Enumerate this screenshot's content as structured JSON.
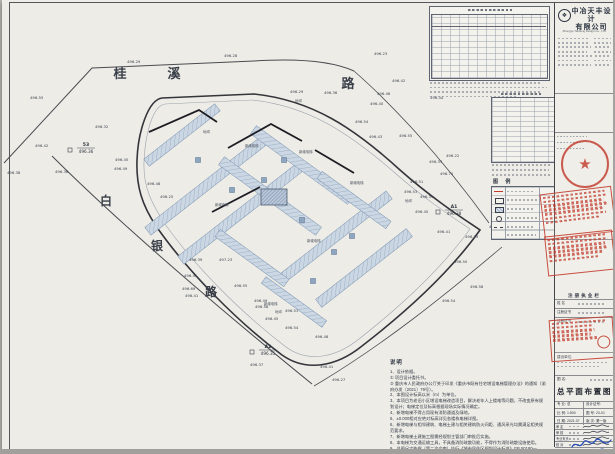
{
  "company": {
    "name_line1": "中冶天丰设计",
    "name_line2": "有限公司",
    "english": "Zhongye Tianfeng Design Co., LTD"
  },
  "title_block": {
    "registration_header": "注册执业栏",
    "reg_rows": [
      "姓  名",
      "注册证书",
      "注册证书"
    ],
    "client_label": "建设单位:",
    "drawing_name_label": "图 名:",
    "drawing_name": "总平面布置图",
    "fields": [
      {
        "label": "专 业",
        "value": "总"
      },
      {
        "label": "设计证号",
        "value": ""
      },
      {
        "label": "比 例",
        "value": "1:500"
      },
      {
        "label": "图 号",
        "value": "23-01"
      },
      {
        "label": "日 期",
        "value": "2021.07"
      },
      {
        "label": "版 次",
        "value": "第一版"
      }
    ],
    "sig_rows": [
      "审 定",
      "审 核",
      "专业负责",
      "校 对",
      "设 计"
    ]
  },
  "legend": {
    "title": "图 例"
  },
  "notes": {
    "title": "说明",
    "lines": [
      "1、设计依据。",
      "① 项目设计委托书。",
      "② 重庆市人民政府办公厅关于印发《重庆市既有住宅增设电梯管理办法》的通知（渝府办发〔2021〕79号）。",
      "2、本图设计标高以米（m）为单位。",
      "3、本项目为老旧小区增设电梯改造项目，解决老年人上楼难等问题，不改变原有规划设计；电梯定位及标高根据现场实际情况确定。",
      "4、新增电梯不得占用现有消防通道及绿地。",
      "5、±0.000相对应绝对标高详见各楼栋电梯详图。",
      "6、新增电梯与相邻建筑、电梯土建与相关建筑防火间距、通风采光均需满足相关规范要求。",
      "7、新增电梯土建施工图需经规划主管部门审批后实施。",
      "8、本电梯为交通运输工具，不具备消防疏散功能，不得作为消防疏散设施使用。",
      "9、总图尺寸依据（第二次会审）执行《城市居住区规划设计标准》GB 50180—2018。"
    ]
  },
  "plan": {
    "road_chars": [
      {
        "c": "桂",
        "x": 118,
        "y": 78,
        "s": 13
      },
      {
        "c": "溪",
        "x": 172,
        "y": 78,
        "s": 13
      },
      {
        "c": "路",
        "x": 346,
        "y": 88,
        "s": 13
      },
      {
        "c": "白",
        "x": 104,
        "y": 205,
        "s": 12
      },
      {
        "c": "银",
        "x": 155,
        "y": 250,
        "s": 12
      },
      {
        "c": "路",
        "x": 209,
        "y": 296,
        "s": 12
      }
    ],
    "ground_label": "地坪",
    "ground_pts": [
      {
        "x": 201,
        "y": 133
      },
      {
        "x": 293,
        "y": 102
      },
      {
        "x": 403,
        "y": 202
      },
      {
        "x": 273,
        "y": 313
      }
    ],
    "elevator_label": "新增电梯",
    "elevator_pts": [
      {
        "x": 243,
        "y": 147
      },
      {
        "x": 297,
        "y": 153
      },
      {
        "x": 348,
        "y": 184
      },
      {
        "x": 213,
        "y": 206
      },
      {
        "x": 305,
        "y": 242
      },
      {
        "x": 262,
        "y": 305
      }
    ],
    "refs": [
      {
        "name": "A1",
        "elev": "496.38",
        "x": 452,
        "y": 208
      },
      {
        "name": "A2",
        "elev": "496.35",
        "x": 266,
        "y": 348
      },
      {
        "name": "53",
        "elev": "496.36",
        "x": 84,
        "y": 146
      }
    ],
    "spots": [
      {
        "v": "496.29",
        "x": 125,
        "y": 63
      },
      {
        "v": "496.28",
        "x": 222,
        "y": 57
      },
      {
        "v": "496.23",
        "x": 372,
        "y": 55
      },
      {
        "v": "496.55",
        "x": 28,
        "y": 99
      },
      {
        "v": "496.42",
        "x": 33,
        "y": 147
      },
      {
        "v": "496.38",
        "x": 5,
        "y": 174
      },
      {
        "v": "496.38",
        "x": 53,
        "y": 173
      },
      {
        "v": "496.32",
        "x": 93,
        "y": 128
      },
      {
        "v": "496.45",
        "x": 113,
        "y": 161
      },
      {
        "v": "496.49",
        "x": 112,
        "y": 170
      },
      {
        "v": "496.48",
        "x": 145,
        "y": 185
      },
      {
        "v": "496.25",
        "x": 158,
        "y": 198
      },
      {
        "v": "496.29",
        "x": 288,
        "y": 93
      },
      {
        "v": "496.36",
        "x": 322,
        "y": 94
      },
      {
        "v": "496.46",
        "x": 375,
        "y": 95
      },
      {
        "v": "496.42",
        "x": 390,
        "y": 82
      },
      {
        "v": "496.40",
        "x": 368,
        "y": 105
      },
      {
        "v": "496.54",
        "x": 353,
        "y": 123
      },
      {
        "v": "496.43",
        "x": 367,
        "y": 138
      },
      {
        "v": "496.55",
        "x": 397,
        "y": 137
      },
      {
        "v": "496.44",
        "x": 428,
        "y": 99
      },
      {
        "v": "496.22",
        "x": 444,
        "y": 157
      },
      {
        "v": "496.33",
        "x": 427,
        "y": 163
      },
      {
        "v": "496.70",
        "x": 438,
        "y": 175
      },
      {
        "v": "496.51",
        "x": 408,
        "y": 183
      },
      {
        "v": "496.53",
        "x": 402,
        "y": 193
      },
      {
        "v": "496.33",
        "x": 418,
        "y": 198
      },
      {
        "v": "496.45",
        "x": 413,
        "y": 213
      },
      {
        "v": "496.25",
        "x": 487,
        "y": 228
      },
      {
        "v": "496.39",
        "x": 463,
        "y": 238
      },
      {
        "v": "496.41",
        "x": 435,
        "y": 233
      },
      {
        "v": "496.39",
        "x": 187,
        "y": 261
      },
      {
        "v": "497.23",
        "x": 217,
        "y": 261
      },
      {
        "v": "496.41",
        "x": 182,
        "y": 277
      },
      {
        "v": "496.69",
        "x": 180,
        "y": 290
      },
      {
        "v": "496.41",
        "x": 183,
        "y": 297
      },
      {
        "v": "496.55",
        "x": 232,
        "y": 287
      },
      {
        "v": "496.49",
        "x": 252,
        "y": 302
      },
      {
        "v": "496.58",
        "x": 253,
        "y": 308
      },
      {
        "v": "496.51",
        "x": 283,
        "y": 312
      },
      {
        "v": "496.45",
        "x": 263,
        "y": 320
      },
      {
        "v": "496.54",
        "x": 283,
        "y": 329
      },
      {
        "v": "496.50",
        "x": 452,
        "y": 263
      },
      {
        "v": "496.58",
        "x": 468,
        "y": 288
      },
      {
        "v": "496.54",
        "x": 440,
        "y": 302
      },
      {
        "v": "496.48",
        "x": 313,
        "y": 338
      },
      {
        "v": "496.37",
        "x": 248,
        "y": 366
      },
      {
        "v": "496.41",
        "x": 318,
        "y": 368
      },
      {
        "v": "496.27",
        "x": 330,
        "y": 381
      }
    ],
    "buildings": [
      {
        "x": 205,
        "y": 185,
        "l": 150,
        "t": 10,
        "r": -38
      },
      {
        "x": 238,
        "y": 214,
        "l": 150,
        "t": 10,
        "r": -38
      },
      {
        "x": 300,
        "y": 165,
        "l": 120,
        "t": 10,
        "r": 36
      },
      {
        "x": 268,
        "y": 196,
        "l": 120,
        "t": 10,
        "r": 36
      },
      {
        "x": 332,
        "y": 238,
        "l": 140,
        "t": 10,
        "r": -38
      },
      {
        "x": 362,
        "y": 268,
        "l": 115,
        "t": 10,
        "r": -38
      },
      {
        "x": 352,
        "y": 200,
        "l": 85,
        "t": 9,
        "r": 36
      },
      {
        "x": 250,
        "y": 258,
        "l": 85,
        "t": 9,
        "r": 36
      },
      {
        "x": 180,
        "y": 135,
        "l": 90,
        "t": 9,
        "r": -38
      },
      {
        "x": 292,
        "y": 302,
        "l": 75,
        "t": 8,
        "r": 36
      }
    ],
    "elevator_boxes": [
      {
        "x": 196,
        "y": 160
      },
      {
        "x": 230,
        "y": 190
      },
      {
        "x": 262,
        "y": 180
      },
      {
        "x": 300,
        "y": 220
      },
      {
        "x": 332,
        "y": 252
      },
      {
        "x": 282,
        "y": 160
      },
      {
        "x": 350,
        "y": 236
      },
      {
        "x": 311,
        "y": 281
      }
    ],
    "bold_walls": [
      "M147,132 L197,110 L215,122",
      "M226,148 L269,124 L300,141",
      "M210,212 L258,187",
      "M313,150 L352,173"
    ]
  }
}
